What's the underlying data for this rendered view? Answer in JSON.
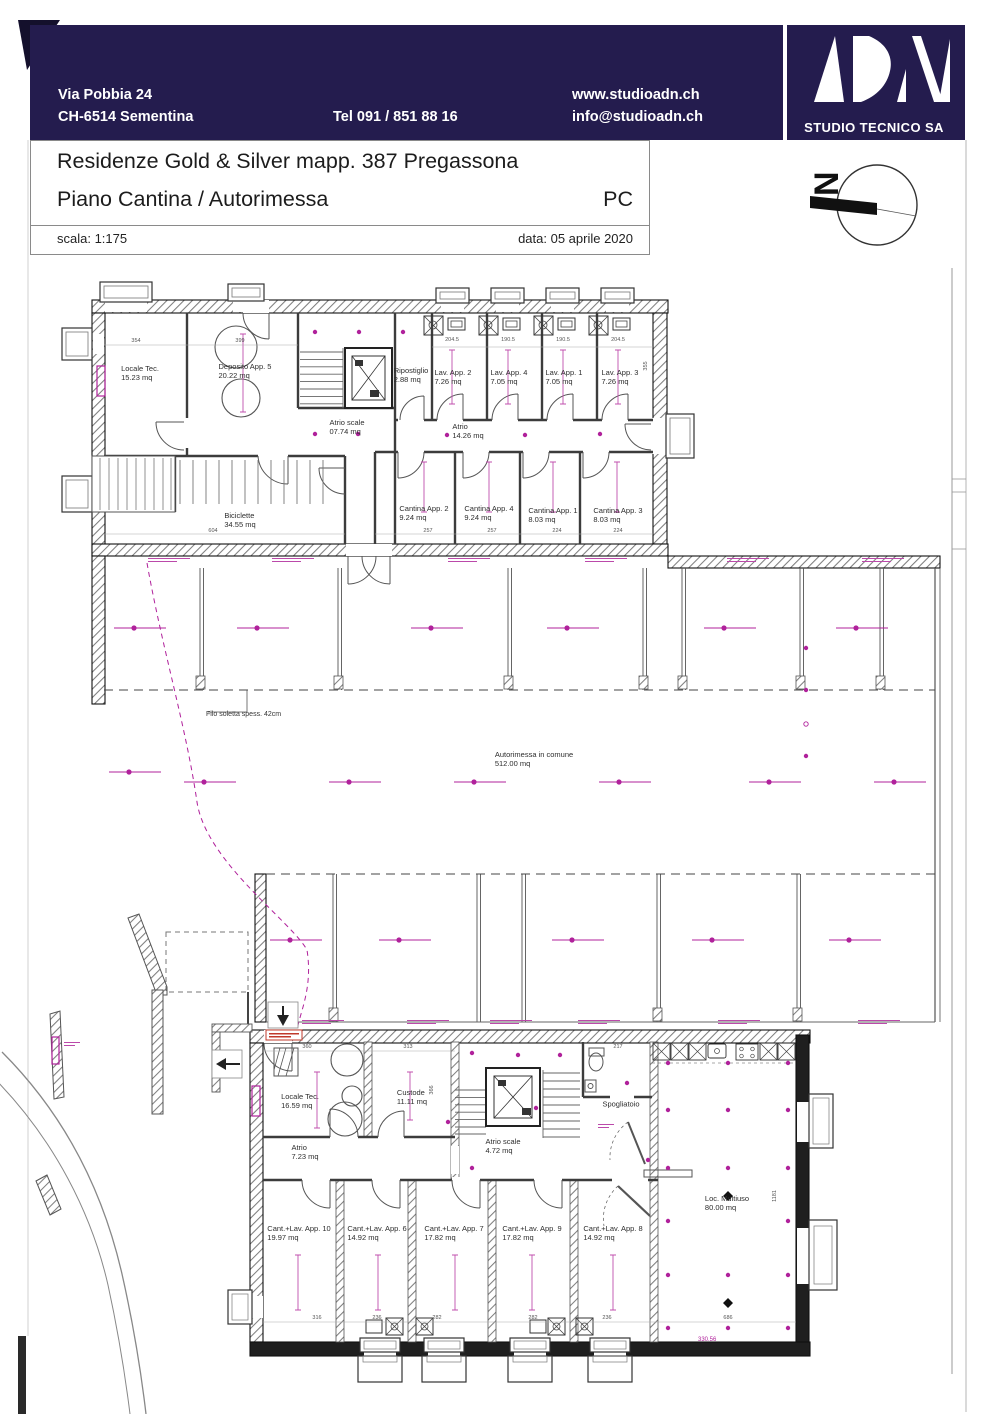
{
  "header": {
    "address_line1": "Via Pobbia 24",
    "address_line2": "CH-6514 Sementina",
    "phone": "Tel  091 / 851 88 16",
    "website": "www.studioadn.ch",
    "email": "info@studioadn.ch",
    "logo_text": "ADN",
    "company": "STUDIO TECNICO SA"
  },
  "title_block": {
    "line1": "Residenze Gold & Silver  mapp. 387 Pregassona",
    "line2": "Piano Cantina / Autorimessa",
    "code": "PC",
    "scale": "scala:  1:175",
    "date": "data: 05 aprile 2020"
  },
  "north": {
    "label": "N"
  },
  "colors": {
    "header_bg": "#241c4e",
    "magenta": "#b0219b",
    "wall": "#1a1a1a"
  },
  "filo_note": {
    "text": "Filo soletta spess. 42cm"
  },
  "elevation_note": {
    "text": "330.56"
  },
  "plan_labels": [
    {
      "name": "Locale Tec.",
      "area": "15.23 mq",
      "x": 140,
      "y": 374
    },
    {
      "name": "Deposito App. 5",
      "area": "20.22 mq",
      "x": 245,
      "y": 372
    },
    {
      "name": "Ripostiglio",
      "area": "2.88 mq",
      "x": 411,
      "y": 376
    },
    {
      "name": "Lav. App. 2",
      "area": "7.26 mq",
      "x": 453,
      "y": 378
    },
    {
      "name": "Lav. App. 4",
      "area": "7.05 mq",
      "x": 509,
      "y": 378
    },
    {
      "name": "Lav. App. 1",
      "area": "7.05 mq",
      "x": 564,
      "y": 378
    },
    {
      "name": "Lav. App. 3",
      "area": "7.26 mq",
      "x": 620,
      "y": 378
    },
    {
      "name": "Atrio scale",
      "area": "07.74 mq",
      "x": 347,
      "y": 428
    },
    {
      "name": "Atrio",
      "area": "14.26 mq",
      "x": 468,
      "y": 432
    },
    {
      "name": "Biciclette",
      "area": "34.55 mq",
      "x": 240,
      "y": 521
    },
    {
      "name": "Cantina App. 2",
      "area": "9.24 mq",
      "x": 424,
      "y": 514
    },
    {
      "name": "Cantina App. 4",
      "area": "9.24 mq",
      "x": 489,
      "y": 514
    },
    {
      "name": "Cantina App. 1",
      "area": "8.03 mq",
      "x": 553,
      "y": 516
    },
    {
      "name": "Cantina App. 3",
      "area": "8.03 mq",
      "x": 618,
      "y": 516
    },
    {
      "name": "Autorimessa in comune",
      "area": "512.00 mq",
      "x": 534,
      "y": 760
    },
    {
      "name": "Locale Tec.",
      "area": "16.59 mq",
      "x": 300,
      "y": 1102
    },
    {
      "name": "Custode",
      "area": "11.11 mq",
      "x": 412,
      "y": 1098
    },
    {
      "name": "Atrio",
      "area": "7.23 mq",
      "x": 305,
      "y": 1153
    },
    {
      "name": "Atrio scale",
      "area": "4.72 mq",
      "x": 503,
      "y": 1147
    },
    {
      "name": "Spogliatoio",
      "area": "",
      "x": 621,
      "y": 1105
    },
    {
      "name": "Cant.+Lav. App. 10",
      "area": "19.97 mq",
      "x": 299,
      "y": 1234
    },
    {
      "name": "Cant.+Lav. App. 6",
      "area": "14.92 mq",
      "x": 377,
      "y": 1234
    },
    {
      "name": "Cant.+Lav. App. 7",
      "area": "17.82 mq",
      "x": 454,
      "y": 1234
    },
    {
      "name": "Cant.+Lav. App. 9",
      "area": "17.82 mq",
      "x": 532,
      "y": 1234
    },
    {
      "name": "Cant.+Lav. App. 8",
      "area": "14.92 mq",
      "x": 613,
      "y": 1234
    },
    {
      "name": "Loc. Multiuso",
      "area": "80.00 mq",
      "x": 727,
      "y": 1204
    }
  ],
  "dimensions": [
    {
      "t": "354",
      "x": 136,
      "y": 341
    },
    {
      "t": "399",
      "x": 240,
      "y": 341
    },
    {
      "t": "204.5",
      "x": 452,
      "y": 340
    },
    {
      "t": "190.5",
      "x": 508,
      "y": 340
    },
    {
      "t": "190.5",
      "x": 563,
      "y": 340
    },
    {
      "t": "204.5",
      "x": 618,
      "y": 340
    },
    {
      "t": "355",
      "x": 646,
      "y": 366,
      "v": true
    },
    {
      "t": "604",
      "x": 213,
      "y": 531
    },
    {
      "t": "257",
      "x": 428,
      "y": 531
    },
    {
      "t": "257",
      "x": 492,
      "y": 531
    },
    {
      "t": "224",
      "x": 557,
      "y": 531
    },
    {
      "t": "224",
      "x": 618,
      "y": 531
    },
    {
      "t": "360",
      "x": 307,
      "y": 1047
    },
    {
      "t": "313",
      "x": 408,
      "y": 1047
    },
    {
      "t": "217",
      "x": 618,
      "y": 1047
    },
    {
      "t": "366",
      "x": 432,
      "y": 1090,
      "v": true
    },
    {
      "t": "1181",
      "x": 775,
      "y": 1196,
      "v": true
    },
    {
      "t": "316",
      "x": 317,
      "y": 1318
    },
    {
      "t": "236",
      "x": 377,
      "y": 1318
    },
    {
      "t": "282",
      "x": 437,
      "y": 1318
    },
    {
      "t": "282",
      "x": 533,
      "y": 1318
    },
    {
      "t": "236",
      "x": 607,
      "y": 1318
    },
    {
      "t": "686",
      "x": 728,
      "y": 1318
    }
  ],
  "stall_notes": {
    "positions": [
      [
        148,
        558
      ],
      [
        272,
        558
      ],
      [
        448,
        558
      ],
      [
        585,
        558
      ],
      [
        727,
        558
      ],
      [
        862,
        558
      ],
      [
        302,
        1020
      ],
      [
        407,
        1020
      ],
      [
        490,
        1020
      ],
      [
        578,
        1020
      ],
      [
        718,
        1020
      ],
      [
        858,
        1020
      ],
      [
        64,
        1042,
        16
      ],
      [
        598,
        1124,
        16
      ]
    ]
  }
}
